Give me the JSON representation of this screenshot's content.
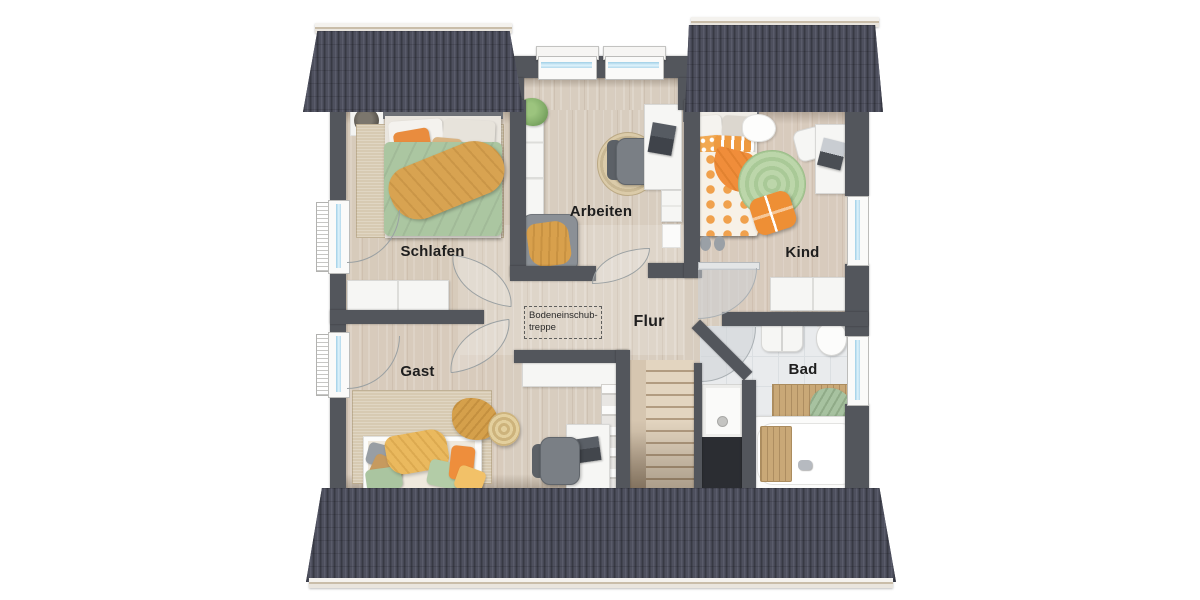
{
  "rooms": {
    "schlafen": {
      "label": "Schlafen"
    },
    "arbeiten": {
      "label": "Arbeiten"
    },
    "kind": {
      "label": "Kind"
    },
    "flur": {
      "label": "Flur"
    },
    "gast": {
      "label": "Gast"
    },
    "bad": {
      "label": "Bad"
    }
  },
  "annotations": {
    "attic_hatch": {
      "line1": "Bodeneinschub-",
      "line2": "treppe"
    }
  },
  "colors": {
    "roof": "#484a57",
    "roof_rib": "#383a44",
    "ridge": "#e9e5de",
    "wall": "#53565c",
    "floor_wood": "#d8cdbf",
    "floor_tile": "#e9ebed",
    "void": "#2b2d32",
    "glass": "#c7e5f4",
    "accent_orange": "#ee8f35",
    "accent_green": "#abc6a1",
    "accent_mustard": "#d8a351"
  }
}
